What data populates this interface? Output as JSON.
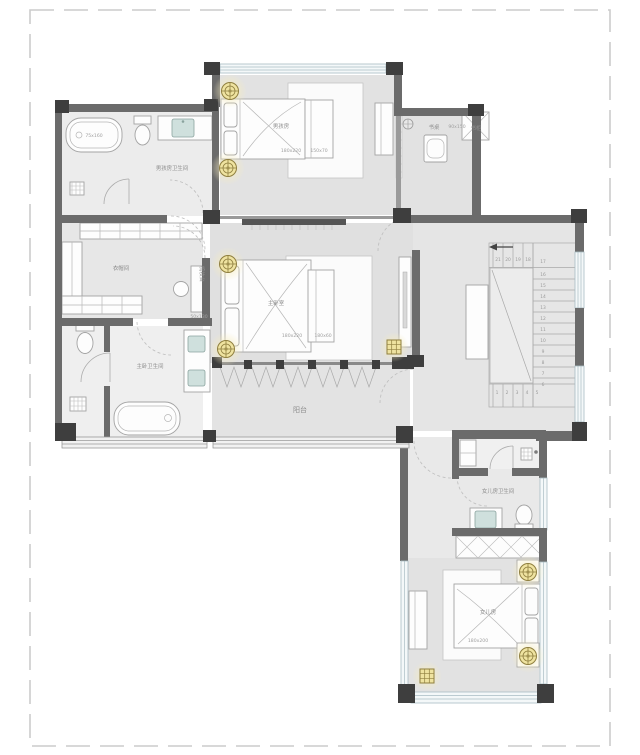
{
  "plan": {
    "rooms": {
      "boy_bedroom": {
        "name": "男孩房",
        "bed_size": "180x220",
        "bench_size": "150x70"
      },
      "study_nook": {
        "desk_label": "书桌",
        "desk_size": "90x150",
        "bookcase_label": "书柜"
      },
      "boy_bathroom": {
        "name": "男孩房卫生间",
        "tub_size": "75x160"
      },
      "walk_in_closet": {
        "name": "衣帽间",
        "dresser_label": "梳妆台",
        "dresser_size": "50x130"
      },
      "master_bedroom": {
        "name": "主卧室",
        "bed_size": "180x220",
        "bench_size": "180x60"
      },
      "master_bathroom": {
        "name": "主卧卫生间"
      },
      "balcony": {
        "name": "阳台"
      },
      "girl_bathroom": {
        "name": "女儿房卫生间"
      },
      "girl_bedroom": {
        "name": "女儿房",
        "bed_size": "180x200"
      }
    },
    "stairs": {
      "top_numbers": [
        "21",
        "20",
        "19",
        "18"
      ],
      "right_numbers": [
        "17",
        "16",
        "15",
        "14",
        "13",
        "12",
        "11",
        "10",
        "9",
        "8",
        "7",
        "6"
      ],
      "bottom_numbers": [
        "1",
        "2",
        "3",
        "4",
        "5"
      ]
    },
    "colors": {
      "wall": "#6b6b6b",
      "wall_corner": "#3e3e3e",
      "floor": "#e3e3e3",
      "accent_light": "#efe3a0",
      "window": "#f4f8f9",
      "sink": "#cfe0dd"
    }
  }
}
